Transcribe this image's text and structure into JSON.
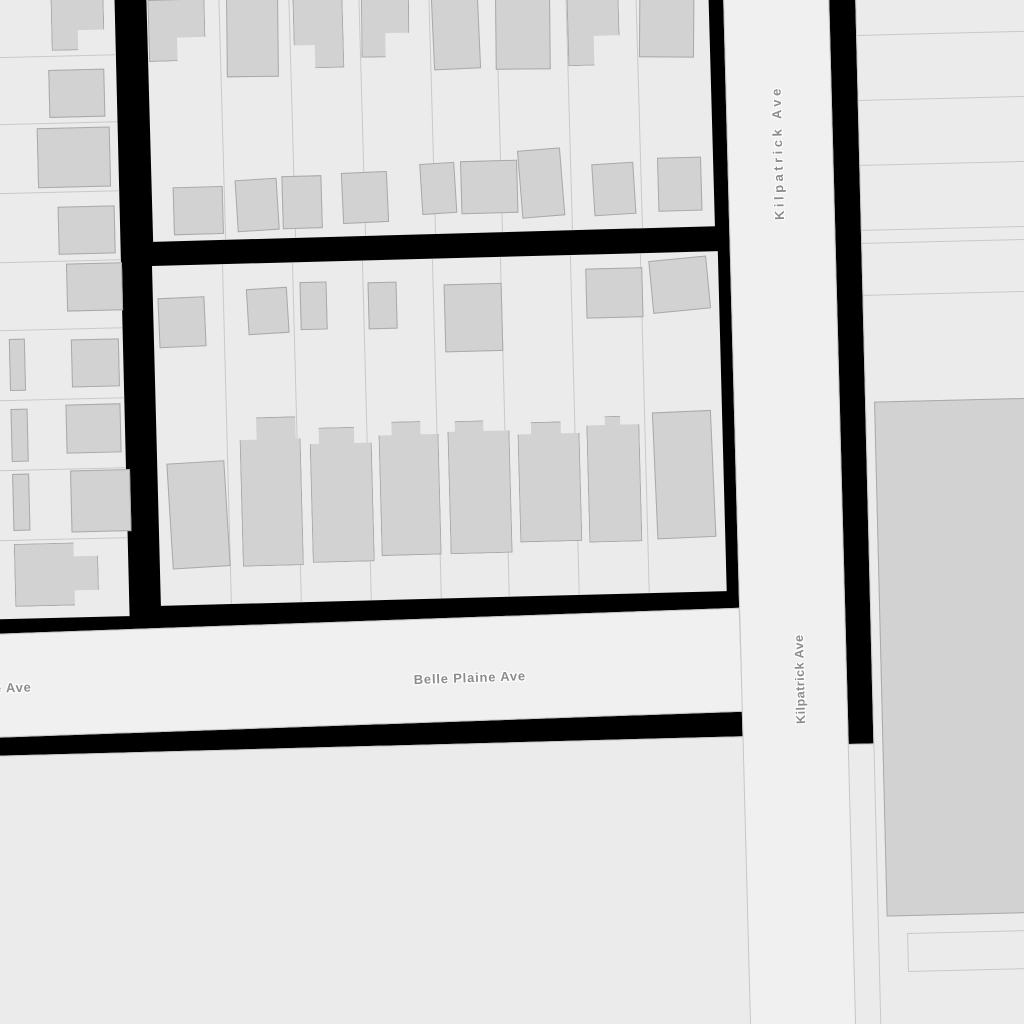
{
  "map": {
    "colors": {
      "background": "#000000",
      "parcel": "#ebebeb",
      "road": "#f0f0f0",
      "building": "#d2d2d2",
      "building_border": "#a9a9a9",
      "parcel_line": "#c9c9c9",
      "road_border": "#c6c6c6",
      "label": "#8c8c8c",
      "halo": "#ffffff"
    },
    "labels": {
      "kilpatrick_upper": "Kilpatrick Ave",
      "kilpatrick_lower": "Kilpatrick Ave",
      "belle_plaine": "Belle Plaine Ave",
      "belle_plaine_partial": "e Ave"
    },
    "blocks": {
      "west": {
        "dividers": {
          "dir": "h",
          "at": [
            78,
            145,
            214,
            283,
            351,
            421,
            491,
            561
          ]
        },
        "buildings": [
          [
            86,
            20,
            53,
            53,
            "stepBR",
            0
          ],
          [
            82,
            92,
            56,
            48,
            "",
            0
          ],
          [
            69,
            150,
            73,
            60,
            "",
            0
          ],
          [
            88,
            229,
            57,
            48,
            "",
            0
          ],
          [
            95,
            286,
            56,
            48,
            "",
            0
          ],
          [
            98,
            362,
            48,
            48,
            "",
            0
          ],
          [
            36,
            360,
            16,
            52,
            "",
            0
          ],
          [
            91,
            427,
            55,
            49,
            "",
            0
          ],
          [
            36,
            430,
            17,
            53,
            "",
            0
          ],
          [
            94,
            493,
            60,
            62,
            "",
            0
          ],
          [
            36,
            495,
            17,
            57,
            "",
            0
          ],
          [
            36,
            565,
            84,
            63,
            "tabR",
            0
          ]
        ]
      },
      "north": {
        "dividers": {
          "dir": "v",
          "at": [
            72,
            142,
            212,
            282,
            349,
            419,
            489
          ]
        },
        "buildings": [
          [
            1,
            14,
            57,
            62,
            "stepBR",
            0
          ],
          [
            79,
            14,
            52,
            80,
            "",
            1
          ],
          [
            146,
            14,
            50,
            73,
            "stepBL",
            0
          ],
          [
            214,
            14,
            48,
            64,
            "stepBR",
            1
          ],
          [
            285,
            14,
            47,
            78,
            "",
            -1
          ],
          [
            348,
            14,
            55,
            80,
            "",
            1
          ],
          [
            420,
            14,
            52,
            78,
            "stepBR",
            0
          ],
          [
            492,
            14,
            55,
            72,
            "",
            2
          ],
          [
            21,
            202,
            50,
            48,
            "",
            0
          ],
          [
            84,
            196,
            42,
            52,
            "",
            -2
          ],
          [
            130,
            194,
            40,
            53,
            "",
            0
          ],
          [
            190,
            192,
            46,
            51,
            "",
            -1
          ],
          [
            269,
            185,
            35,
            51,
            "",
            -2
          ],
          [
            309,
            184,
            57,
            53,
            "",
            0
          ],
          [
            368,
            174,
            43,
            68,
            "",
            -3
          ],
          [
            441,
            190,
            42,
            52,
            "",
            -2
          ],
          [
            506,
            186,
            44,
            54,
            "",
            0
          ]
        ]
      },
      "mid": {
        "dividers": {
          "dir": "v",
          "at": [
            70,
            140,
            210,
            280,
            348,
            418,
            488
          ]
        },
        "buildings": [
          [
            5,
            32,
            47,
            50,
            "",
            -1
          ],
          [
            94,
            25,
            41,
            46,
            "",
            -2
          ],
          [
            147,
            20,
            27,
            48,
            "",
            0
          ],
          [
            215,
            22,
            29,
            47,
            "",
            0
          ],
          [
            291,
            26,
            58,
            68,
            "",
            0
          ],
          [
            433,
            14,
            57,
            50,
            "",
            0
          ],
          [
            498,
            6,
            58,
            53,
            "",
            -4
          ],
          [
            11,
            197,
            58,
            106,
            "",
            -2
          ],
          [
            83,
            154,
            61,
            149,
            "bumpR",
            0
          ],
          [
            153,
            166,
            62,
            135,
            "bumpC",
            0
          ],
          [
            222,
            162,
            60,
            134,
            "bumpC2",
            0
          ],
          [
            291,
            163,
            62,
            133,
            "bumpL",
            0
          ],
          [
            361,
            166,
            62,
            120,
            "bumpC2",
            0
          ],
          [
            430,
            162,
            53,
            126,
            "bumpS",
            0
          ],
          [
            497,
            159,
            59,
            127,
            "",
            -1
          ]
        ]
      },
      "east": {
        "dividers": {
          "dir": "h",
          "at": [
            45,
            110,
            175,
            240,
            253,
            305
          ],
          "segments": [
            [
              28,
              944,
              147,
              1
            ],
            [
              28,
              982,
              152,
              1
            ],
            [
              28,
              944,
              1,
              39
            ]
          ]
        },
        "buildings": [
          [
            8,
            412,
            170,
            515,
            "",
            0
          ]
        ]
      },
      "south": {
        "dividers": {
          "dir": "h",
          "at": []
        },
        "buildings": []
      }
    }
  }
}
